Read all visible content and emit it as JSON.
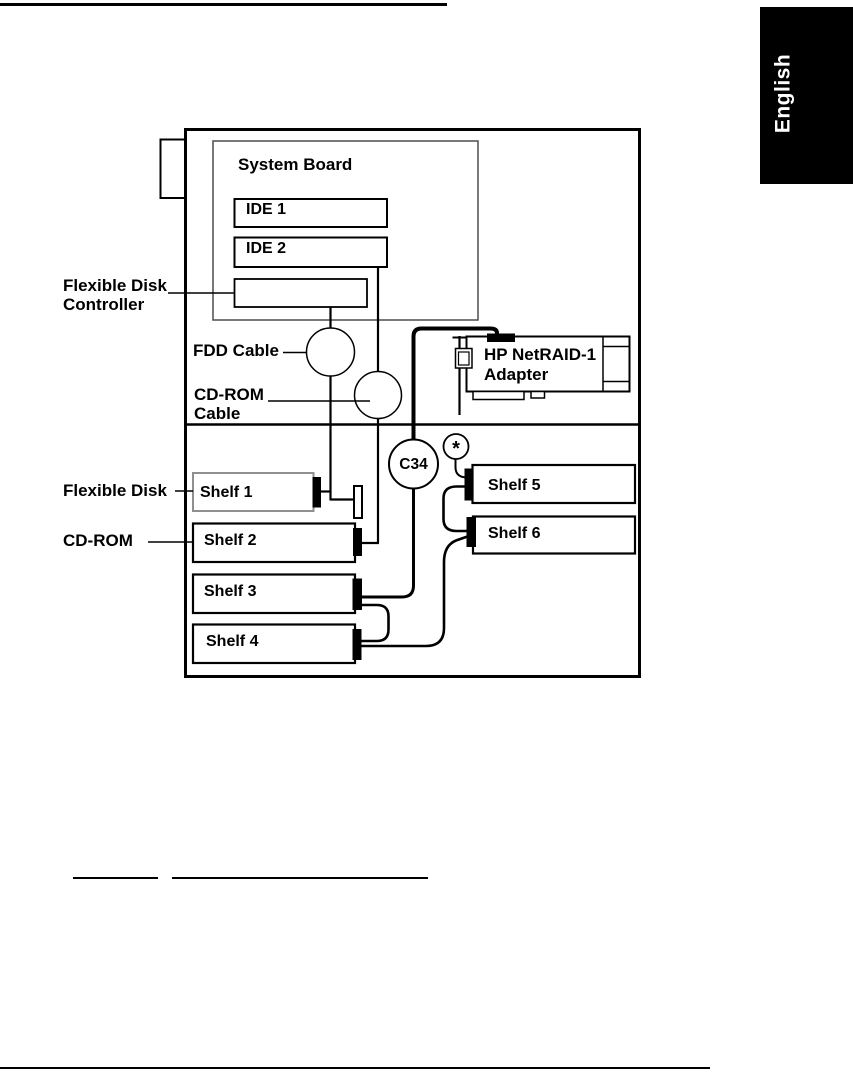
{
  "page": {
    "language_tab": "English",
    "colors": {
      "ink": "#000000",
      "paper": "#ffffff",
      "shelf1_border": "#8f8f8f"
    }
  },
  "diagram": {
    "system_board": {
      "title": "System Board",
      "ide1": "IDE 1",
      "ide2": "IDE 2"
    },
    "labels": {
      "flexible_disk_controller_line1": "Flexible Disk",
      "flexible_disk_controller_line2": "Controller",
      "fdd_cable": "FDD Cable",
      "cdrom_cable_line1": "CD-ROM",
      "cdrom_cable_line2": "Cable",
      "flexible_disk": "Flexible Disk",
      "cdrom": "CD-ROM"
    },
    "adapter": {
      "line1": "HP NetRAID-1",
      "line2": "Adapter"
    },
    "cable_connector": "C34",
    "terminator_mark": "*",
    "shelves": [
      {
        "label": "Shelf 1"
      },
      {
        "label": "Shelf 2"
      },
      {
        "label": "Shelf 3"
      },
      {
        "label": "Shelf 4"
      },
      {
        "label": "Shelf 5"
      },
      {
        "label": "Shelf 6"
      }
    ]
  }
}
